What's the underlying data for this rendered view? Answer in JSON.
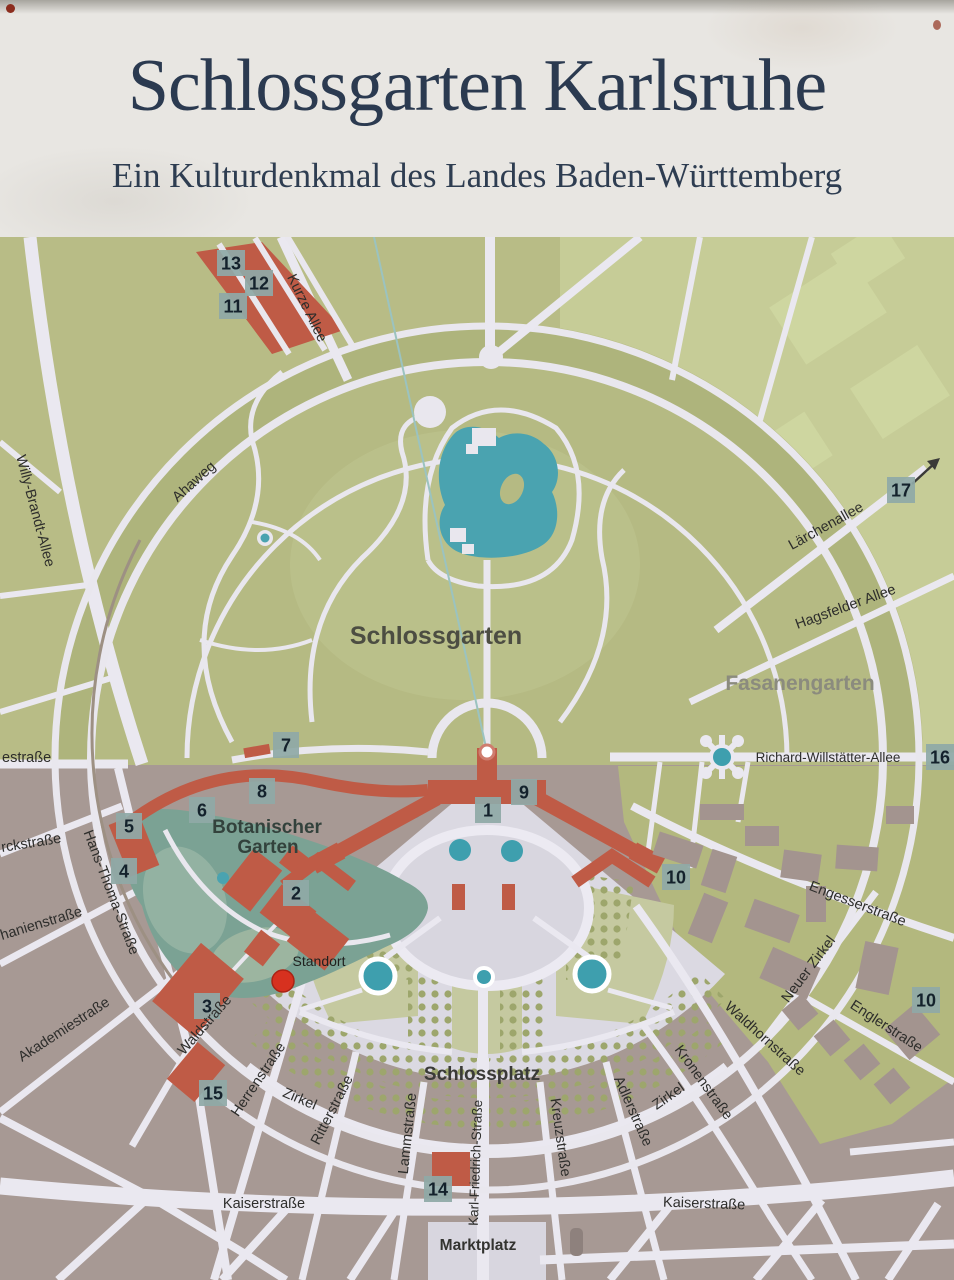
{
  "sign": {
    "title": "Schlossgarten Karlsruhe",
    "subtitle": "Ein Kulturdenkmal des Landes Baden-Württemberg"
  },
  "map": {
    "areas": {
      "schlossgarten": "Schlossgarten",
      "fasanengarten": "Fasanengarten",
      "botanischer_garten_line1": "Botanischer",
      "botanischer_garten_line2": "Garten",
      "schlossplatz": "Schlossplatz",
      "marktplatz": "Marktplatz",
      "standort": "Standort"
    },
    "streets": {
      "kurze_allee": "Kurze Allee",
      "ahaweg": "Ahaweg",
      "willy_brandt_allee": "Willy-Brandt-Allee",
      "moltkestrasse_partial": "estraße",
      "bismarckstrasse_partial": "rckstraße",
      "stephanienstrasse_partial": "hanienstraße",
      "akademiestrasse": "Akademiestraße",
      "hans_thoma_strasse": "Hans-Thoma-Straße",
      "waldstrasse": "Waldstraße",
      "herrenstrasse": "Herrenstraße",
      "zirkel_west": "Zirkel",
      "ritterstrasse": "Ritterstraße",
      "lammstrasse": "Lammstraße",
      "karl_friedrich_strasse": "Karl-Friedrich-Straße",
      "kreuzstrasse": "Kreuzstraße",
      "adlerstrasse": "Adlerstraße",
      "zirkel_east": "Zirkel",
      "kronenstrasse": "Kronenstraße",
      "waldhornstrasse": "Waldhornstraße",
      "neuer_zirkel": "Neuer Zirkel",
      "engesserstrasse": "Engesserstraße",
      "englerstrasse": "Englerstraße",
      "kaiserstrasse_west": "Kaiserstraße",
      "kaiserstrasse_east": "Kaiserstraße",
      "laerchenallee": "Lärchenallee",
      "hagsfelder_allee": "Hagsfelder Allee",
      "richard_willstaetter_allee": "Richard-Willstätter-Allee"
    },
    "markers": {
      "m1": "1",
      "m2": "2",
      "m3": "3",
      "m4": "4",
      "m5": "5",
      "m6": "6",
      "m7": "7",
      "m8": "8",
      "m9": "9",
      "m10a": "10",
      "m10b": "10",
      "m11": "11",
      "m12": "12",
      "m13": "13",
      "m14": "14",
      "m15": "15",
      "m16": "16",
      "m17": "17"
    },
    "colors": {
      "title_text": "#2b3a50",
      "park_green": "#b8bc86",
      "park_light_green": "#c6cc97",
      "botanical_teal": "#7ba294",
      "lake_teal": "#4aa3b0",
      "building_red": "#bf5b46",
      "urban_gray": "#a79994",
      "campus_olive": "#b3b87e",
      "street_white": "#eae8f0",
      "marker_badge": "#8fa9a7",
      "standort_red": "#d7311f"
    }
  }
}
